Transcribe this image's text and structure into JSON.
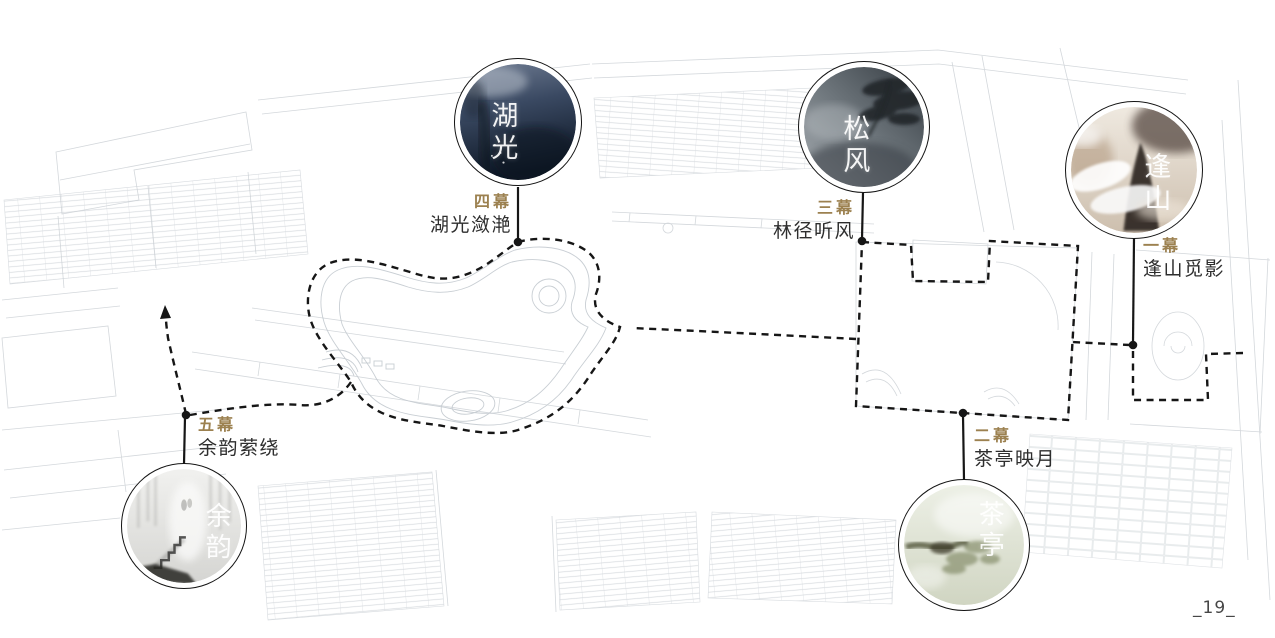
{
  "slide": {
    "page_number": "_19_"
  },
  "palette": {
    "act_label_gold": "#9c8150",
    "scene_name_dark": "#2e2e2e",
    "route_ink": "#161616",
    "plan_line_gray": "#c9ced3"
  },
  "route": {
    "style": "dashed-tour-line",
    "color": "#161616"
  },
  "scenes": [
    {
      "act_label": "四幕",
      "scene_name": "湖光潋滟",
      "circle_caption": "湖光",
      "photo": "misty-lake-photo",
      "colors": {
        "top": "#707d93",
        "mid": "#3a4962",
        "bottom": "#0d1725"
      }
    },
    {
      "act_label": "三幕",
      "scene_name": "林径听风",
      "circle_caption": "松风",
      "photo": "pine-mist-photo",
      "colors": {
        "top": "#a7adb2",
        "mid": "#6d757b",
        "bottom": "#343b41"
      }
    },
    {
      "act_label": "一幕",
      "scene_name": "逢山觅影",
      "circle_caption": "逢山",
      "photo": "mountain-cloud-photo",
      "colors": {
        "top": "#efe9e0",
        "mid": "#d8c9b8",
        "bottom": "#cdbfae"
      }
    },
    {
      "act_label": "五幕",
      "scene_name": "余韵萦绕",
      "circle_caption": "余韵",
      "photo": "misty-steps-photo",
      "colors": {
        "top": "#f1f1ef",
        "mid": "#e2e2df",
        "bottom": "#d5d5d2"
      }
    },
    {
      "act_label": "二幕",
      "scene_name": "茶亭映月",
      "circle_caption": "茶亭",
      "photo": "tea-pavilion-pine-photo",
      "colors": {
        "top": "#edf0e6",
        "mid": "#dde2d0",
        "bottom": "#d0d5c2"
      }
    }
  ]
}
